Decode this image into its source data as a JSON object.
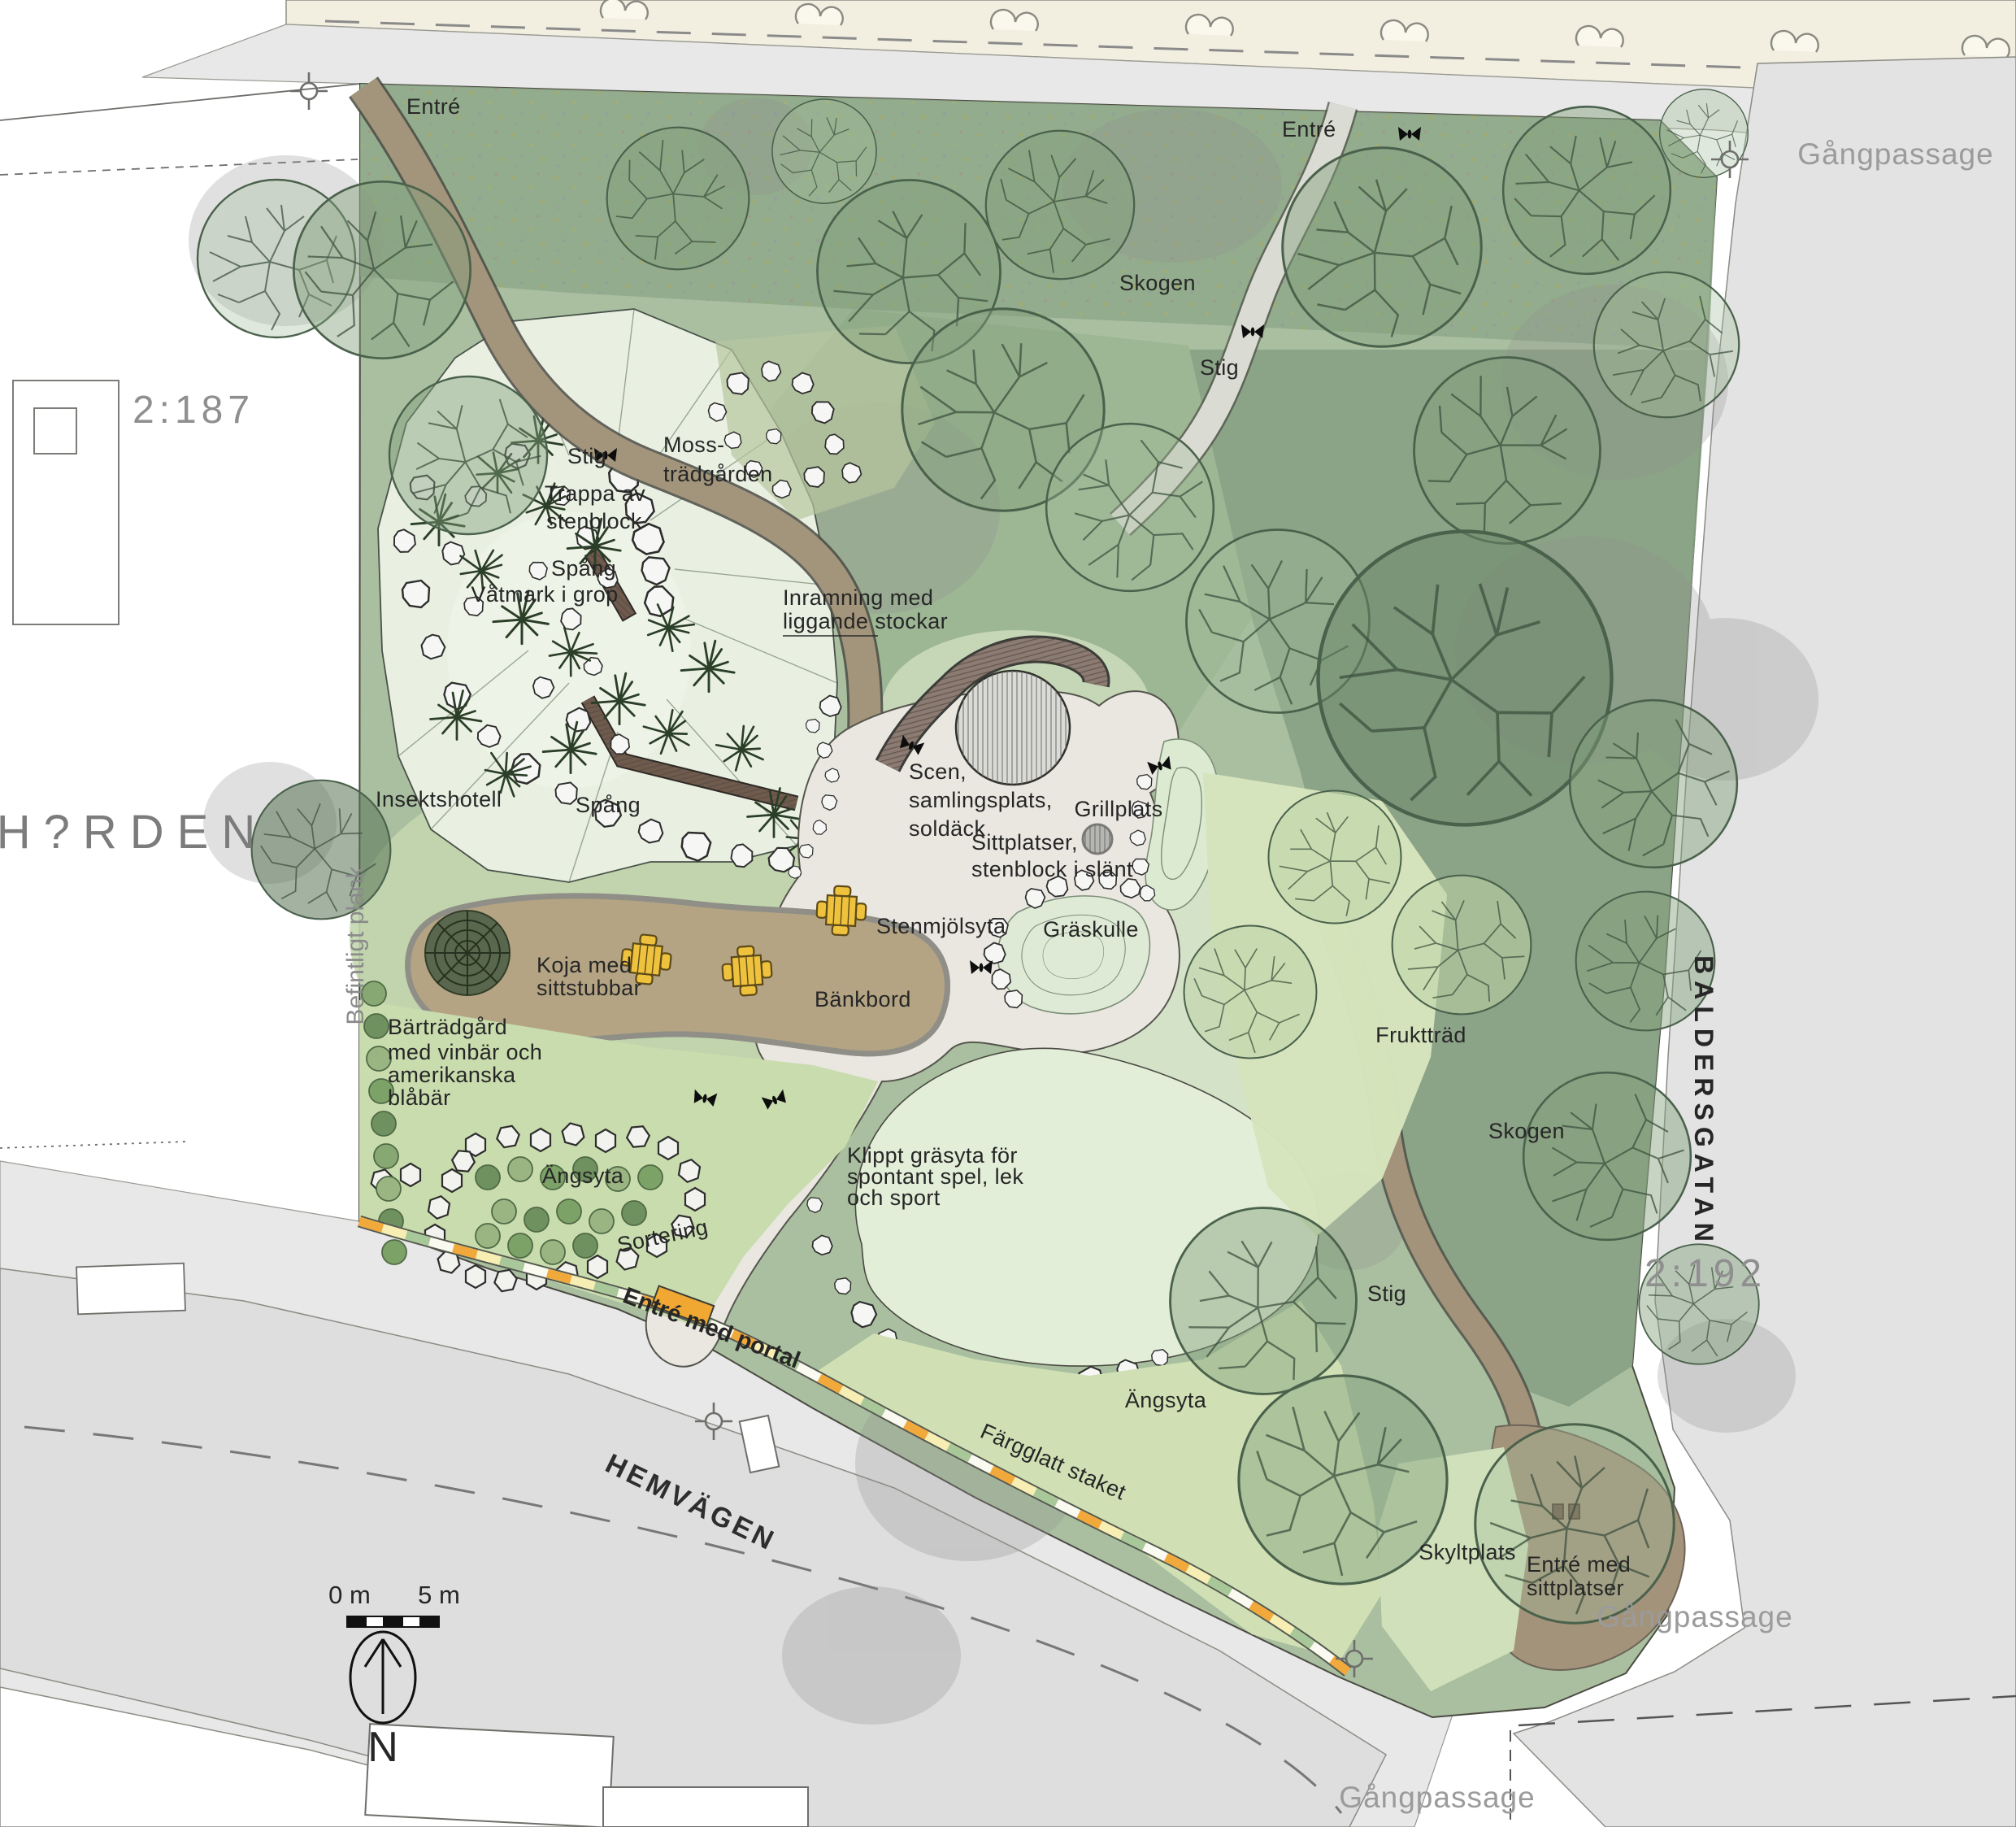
{
  "labels": {
    "entre_nw": "Entré",
    "entre_ne": "Entré",
    "gangpassage_ne": "Gångpassage",
    "gangpassage_e": "Gångpassage",
    "gangpassage_s": "Gångpassage",
    "skogen_n": "Skogen",
    "skogen_e": "Skogen",
    "stig_n": "Stig",
    "stig_w": "Stig",
    "stig_se": "Stig",
    "parcel_nw": "2:187",
    "parcel_e": "2:192",
    "harden": "H?RDEN",
    "moss": [
      "Moss-",
      "trädgården"
    ],
    "trappa": [
      "Trappa av",
      "stenblock"
    ],
    "spang_n": "Spång",
    "spang_s": "Spång",
    "vatmark": "Våtmark i grop",
    "inramning": [
      "Inramning med",
      "liggande stockar"
    ],
    "insektshotell": "Insektshotell",
    "scen": [
      "Scen,",
      "samlingsplats,",
      "soldäck"
    ],
    "grillplats": "Grillplats",
    "sittplatser": [
      "Sittplatser,",
      "stenblock i slänt"
    ],
    "befintligt": "Befintligt plank",
    "stenmjolsyta": "Stenmjölsyta",
    "graskulle": "Gräskulle",
    "koja": [
      "Koja med",
      "sittstubbar"
    ],
    "bankbord": "Bänkbord",
    "bartradgard": [
      "Bärträdgård",
      "med vinbär och",
      "amerikanska",
      "blåbär"
    ],
    "fruktrad": "Fruktträd",
    "baldersgatan": "BALDERSGATAN",
    "angsyta_w": "Ängsyta",
    "angsyta_s": "Ängsyta",
    "klippt": [
      "Klippt gräsyta för",
      "spontant spel, lek",
      "och sport"
    ],
    "sortering": "Sortering",
    "entre_portal": "Entré med portal",
    "farglatt": "Färgglatt staket",
    "hemvagen": "HEMVÄGEN",
    "skyltplats": "Skyltplats",
    "entre_sitt": [
      "Entré med",
      "sittplatser"
    ],
    "scale0": "0 m",
    "scale5": "5 m",
    "north": "N"
  },
  "colors": {
    "fence_orange": "#f2a93b",
    "fence_yellow": "#f6eeb2",
    "fence_green": "#a9c89a",
    "table_yellow": "#eec23d",
    "path_brown": "#a3957b",
    "forest_green": "#9db694",
    "street_gray": "#e2e3e2"
  }
}
